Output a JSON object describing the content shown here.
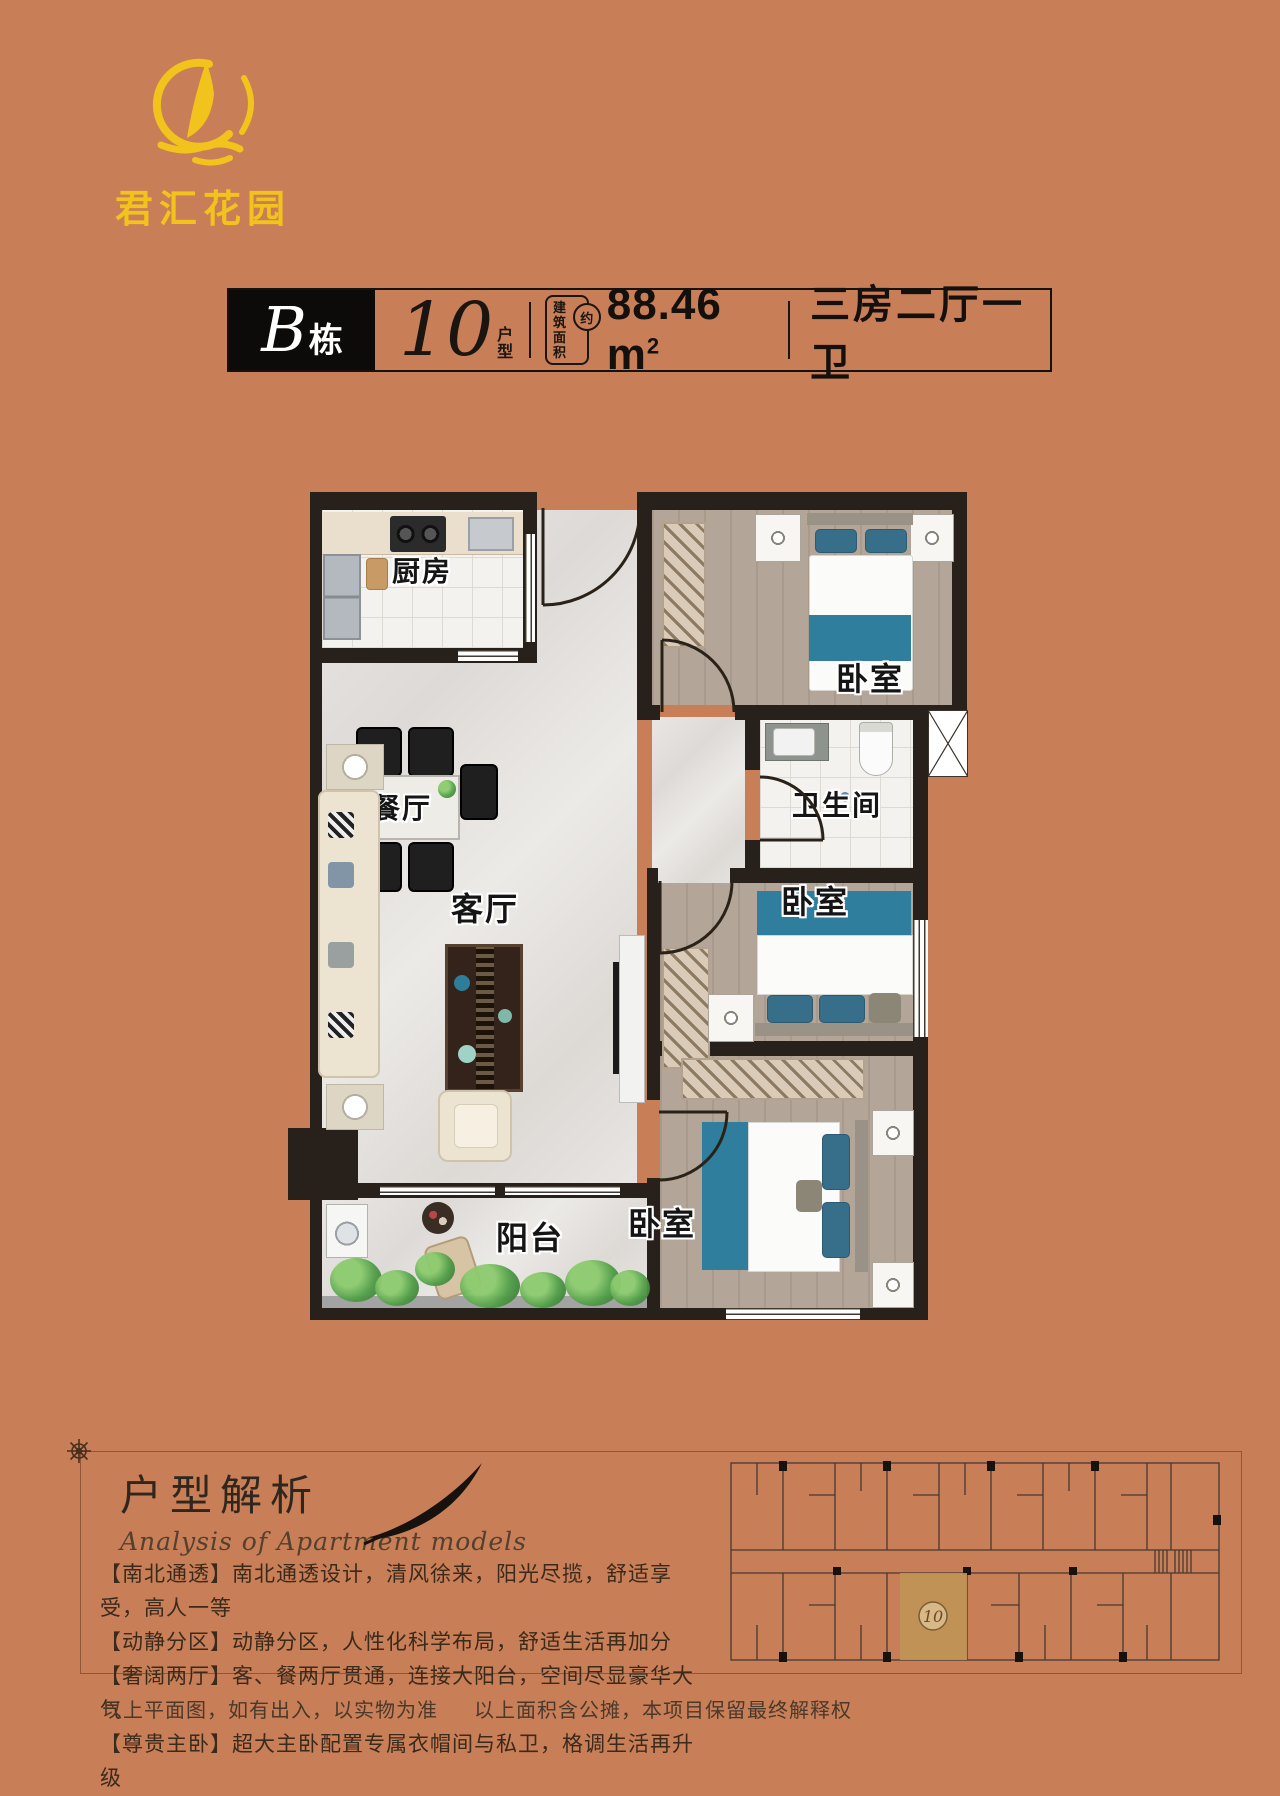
{
  "colors": {
    "background": "#c87e57",
    "logo_yellow": "#f2c31c",
    "wall": "#28201a",
    "bed_accent": "#2f7e9e",
    "highlight_unit": "#bf9456"
  },
  "logo": {
    "name": "君汇花园"
  },
  "title_bar": {
    "building_letter": "B",
    "building_suffix": "栋",
    "unit_number": "10",
    "unit_suffix_top": "户",
    "unit_suffix_bottom": "型",
    "area_badge_line1": "建筑",
    "area_badge_line2": "面积",
    "area_badge_circle": "约",
    "area_value": "88.46 m",
    "area_sup": "2",
    "layout_text": "三房二厅一卫"
  },
  "floor_plan": {
    "rooms": {
      "kitchen": "厨房",
      "dining": "餐厅",
      "living": "客厅",
      "bedroom": "卧室",
      "bathroom": "卫生间",
      "balcony": "阳台"
    }
  },
  "analysis": {
    "title": "户型解析",
    "subtitle": "Analysis of Apartment models",
    "bullets": [
      "【南北通透】南北通透设计，清风徐来，阳光尽揽，舒适享受，高人一等",
      "【动静分区】动静分区，人性化科学布局，舒适生活再加分",
      "【奢阔两厅】客、餐两厅贯通，连接大阳台，空间尽显豪华大气",
      "【尊贵主卧】超大主卧配置专属衣帽间与私卫，格调生活再升级"
    ]
  },
  "key_plan": {
    "unit_label": "10"
  },
  "footer": {
    "disclaimer_left": "以上平面图，如有出入，以实物为准",
    "disclaimer_right": "以上面积含公摊，本项目保留最终解释权"
  }
}
